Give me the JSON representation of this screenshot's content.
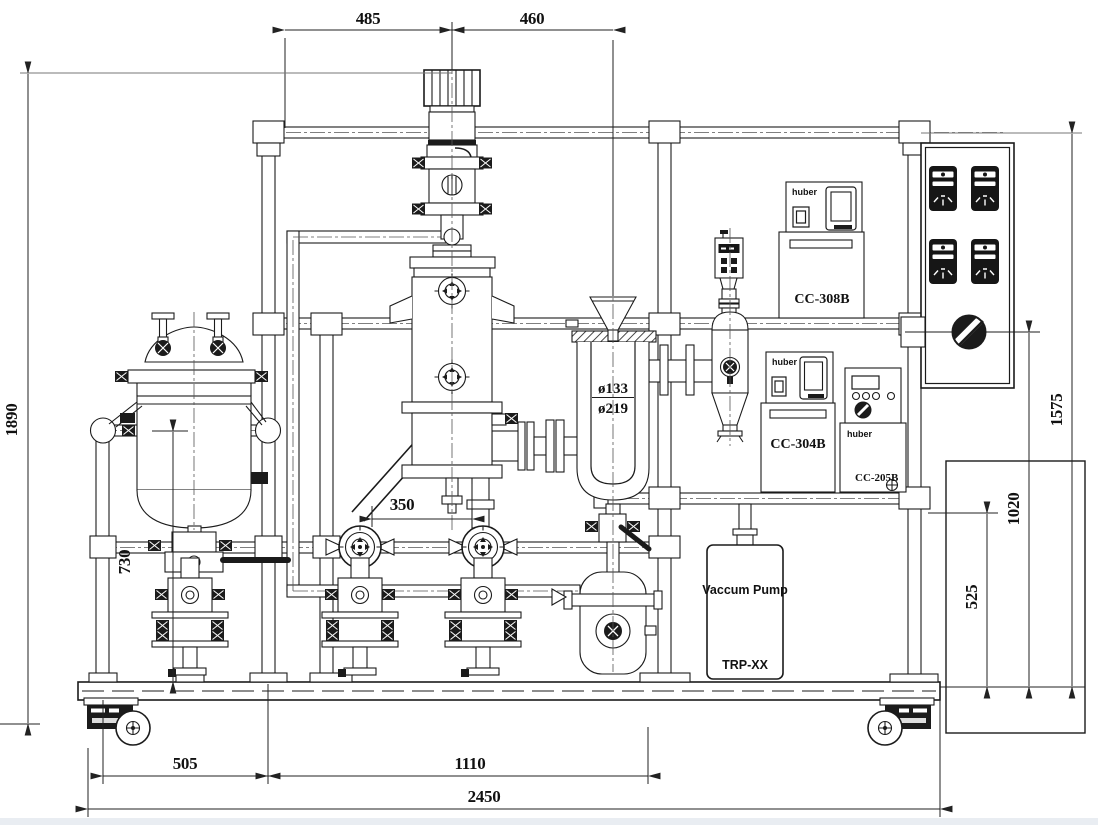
{
  "dimensions": {
    "top_left": "485",
    "top_right": "460",
    "overall_height": "1890",
    "tank_support_height": "730",
    "pump_spacing": "350",
    "trap_inner_dia": "ø133",
    "trap_outer_dia": "ø219",
    "bottom_left": "505",
    "bottom_middle": "1110",
    "overall_width": "2450",
    "right_frame_height": "1575",
    "right_mid_height": "1020",
    "right_lower_height": "525"
  },
  "equipment": {
    "chiller_top": {
      "brand": "huber",
      "model": "CC-308B"
    },
    "chiller_mid": {
      "brand": "huber",
      "model": "CC-304B"
    },
    "controller": {
      "brand": "huber",
      "model": "CC-205B"
    },
    "vacuum_pump": {
      "line1": "Vaccum Pump",
      "line2": "TRP-XX"
    }
  }
}
